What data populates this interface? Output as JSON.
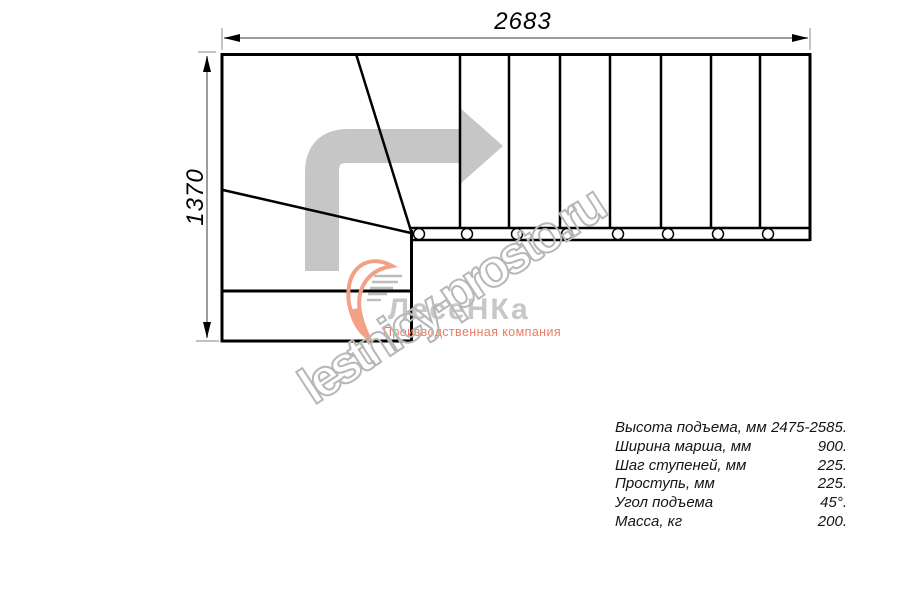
{
  "drawing": {
    "dim_width_label": "2683",
    "dim_height_label": "1370",
    "tread_lines_x": [
      460,
      509,
      560,
      610,
      661,
      711,
      760
    ],
    "baluster_circles_x": [
      419,
      467,
      517,
      567,
      618,
      668,
      718,
      768
    ],
    "colors": {
      "outline": "#000000",
      "dimension_line": "#9c9c9c",
      "direction_arrow": "#c6c6c6"
    }
  },
  "watermark": "lestnicy-prosto.ru",
  "logo": {
    "brand": "ЛесеНКа",
    "tagline": "Производственная компания",
    "accent_color": "#ee8b70"
  },
  "specs": {
    "rows": [
      {
        "label": "Высота подъема, мм",
        "value": "2475-2585."
      },
      {
        "label": "Ширина марша, мм",
        "value": "900."
      },
      {
        "label": "Шаг ступеней, мм",
        "value": "225."
      },
      {
        "label": "Проступь, мм",
        "value": "225."
      },
      {
        "label": "Угол подъема",
        "value": "45°."
      },
      {
        "label": "Масса, кг",
        "value": "200."
      }
    ]
  }
}
